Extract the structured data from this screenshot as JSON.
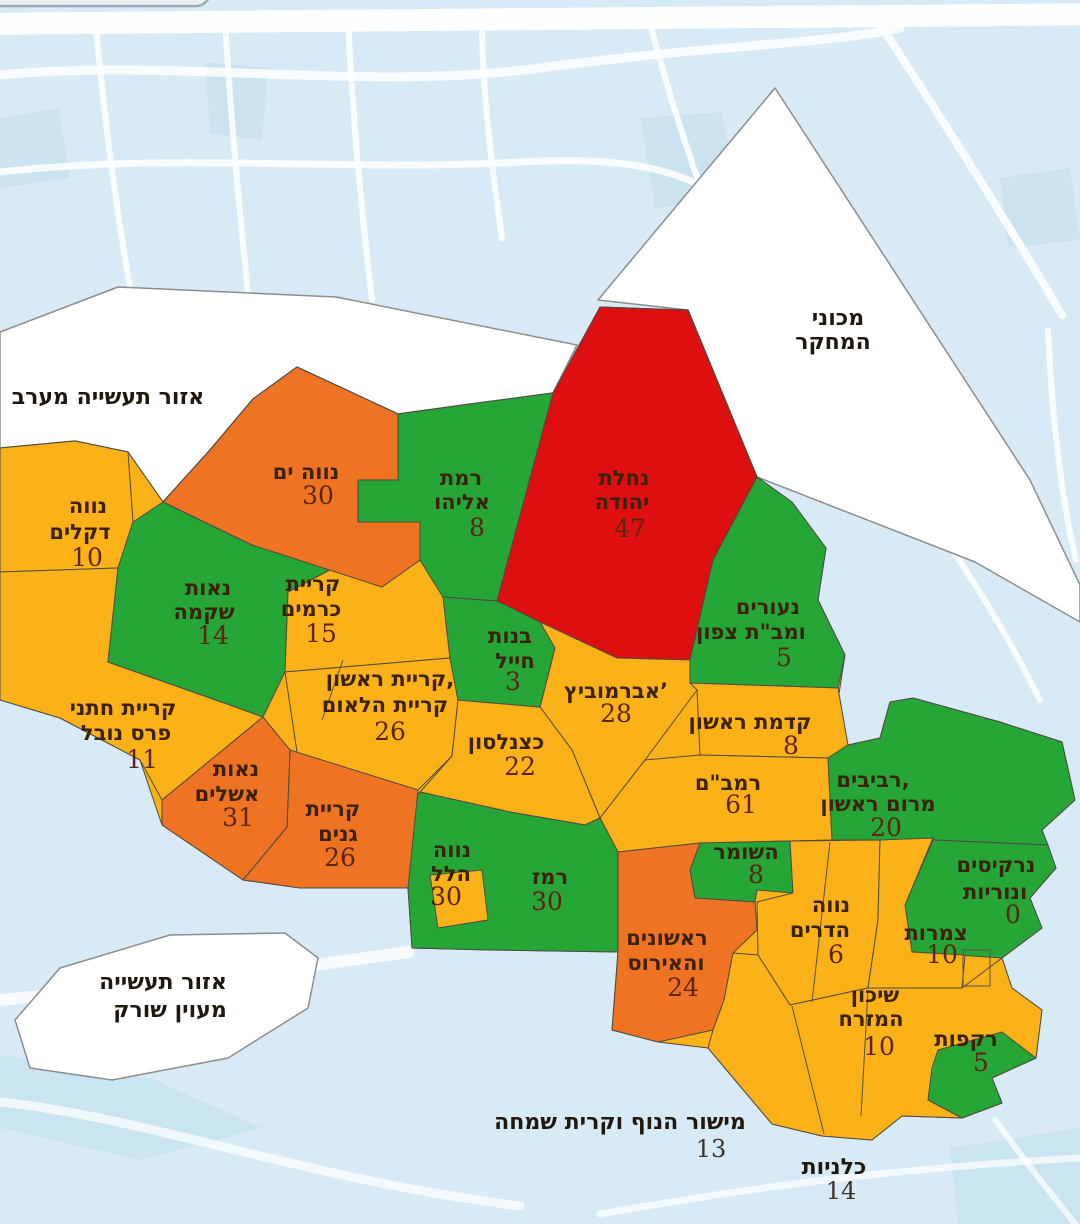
{
  "map": {
    "palette": {
      "green": "#25a636",
      "yellow": "#fbb118",
      "orange": "#ee7322",
      "red": "#dd0f10",
      "water": "#d7eaf5",
      "white_zone": "#ffffff",
      "label_text": "#3a2108",
      "value_text": "#5b2413"
    },
    "regions": [
      {
        "id": "neve-yam",
        "lines": [
          "נווה ים"
        ],
        "value": "30",
        "color": "orange"
      },
      {
        "id": "ramat-eliyahu",
        "lines": [
          "רמת",
          "אליהו"
        ],
        "value": "8",
        "color": "green"
      },
      {
        "id": "nachalat-yehuda",
        "lines": [
          "נחלת",
          "יהודה"
        ],
        "value": "47",
        "color": "red"
      },
      {
        "id": "neve-dkalim",
        "lines": [
          "נווה",
          "דקלים"
        ],
        "value": "10",
        "color": "yellow"
      },
      {
        "id": "neot-shikma",
        "lines": [
          "נאות",
          "שקמה"
        ],
        "value": "14",
        "color": "green"
      },
      {
        "id": "kiryat-carmim",
        "lines": [
          "קריית",
          "כרמים"
        ],
        "value": "15",
        "color": "yellow"
      },
      {
        "id": "bnot-chayil",
        "lines": [
          "בנות",
          "חייל"
        ],
        "value": "3",
        "color": "green"
      },
      {
        "id": "abramovich",
        "lines": [
          "אברמוביץ’"
        ],
        "value": "28",
        "color": "yellow"
      },
      {
        "id": "neurim-mabat",
        "lines": [
          "נעורים",
          "ומב\"ת צפון"
        ],
        "value": "5",
        "color": "green"
      },
      {
        "id": "kidmat-rishon",
        "lines": [
          "קדמת ראשון"
        ],
        "value": "8",
        "color": "yellow"
      },
      {
        "id": "kiryat-rishon",
        "lines": [
          "קריית ראשון,",
          "קריית הלאום"
        ],
        "value": "26",
        "color": "yellow"
      },
      {
        "id": "katznelson",
        "lines": [
          "כצנלסון"
        ],
        "value": "22",
        "color": "yellow"
      },
      {
        "id": "khatani-nobel",
        "lines": [
          "קריית חתני",
          "פרס נובל"
        ],
        "value": "11",
        "color": "yellow"
      },
      {
        "id": "neot-ashalim",
        "lines": [
          "נאות",
          "אשלים"
        ],
        "value": "31",
        "color": "orange"
      },
      {
        "id": "kiryat-ganim",
        "lines": [
          "קריית",
          "גנים"
        ],
        "value": "26",
        "color": "orange"
      },
      {
        "id": "rambam",
        "lines": [
          "רמב\"ם"
        ],
        "value": "61",
        "color": "yellow"
      },
      {
        "id": "revivim-marom",
        "lines": [
          "רביבים,",
          "מרום ראשון"
        ],
        "value": "20",
        "color": "green"
      },
      {
        "id": "hashomer",
        "lines": [
          "השומר"
        ],
        "value": "8",
        "color": "green"
      },
      {
        "id": "neve-hillel",
        "lines": [
          "נווה",
          "הלל"
        ],
        "value": "30",
        "color": "yellow"
      },
      {
        "id": "ramez",
        "lines": [
          "רמז"
        ],
        "value": "30",
        "color": "green"
      },
      {
        "id": "rishonim-irus",
        "lines": [
          "ראשונים",
          "והאירוס"
        ],
        "value": "24",
        "color": "orange"
      },
      {
        "id": "neve-hadarim",
        "lines": [
          "נווה",
          "הדרים"
        ],
        "value": "6",
        "color": "yellow"
      },
      {
        "id": "tsamarot",
        "lines": [
          "צמרות"
        ],
        "value": "10",
        "color": "yellow"
      },
      {
        "id": "shikun-mizrach",
        "lines": [
          "שיכון",
          "המזרח"
        ],
        "value": "10",
        "color": "yellow"
      },
      {
        "id": "narkisim",
        "lines": [
          "נרקיסים",
          "ונוריות"
        ],
        "value": "0",
        "color": "green"
      },
      {
        "id": "rakafot",
        "lines": [
          "רקפות"
        ],
        "value": "5",
        "color": "green"
      }
    ],
    "white_zones": [
      {
        "id": "industrial-west",
        "lines": [
          "אזור תעשייה מערב"
        ]
      },
      {
        "id": "research-institutes",
        "lines": [
          "מכוני",
          "המחקר"
        ]
      },
      {
        "id": "industrial-sorek",
        "lines": [
          "אזור תעשייה",
          "מעוין שורק"
        ]
      }
    ],
    "outside_labels": [
      {
        "id": "mishor-hanof",
        "lines": [
          "מישור הנוף וקרית שמחה"
        ],
        "value": "13"
      },
      {
        "id": "kalaniyot",
        "lines": [
          "כלניות"
        ],
        "value": "14"
      }
    ]
  }
}
